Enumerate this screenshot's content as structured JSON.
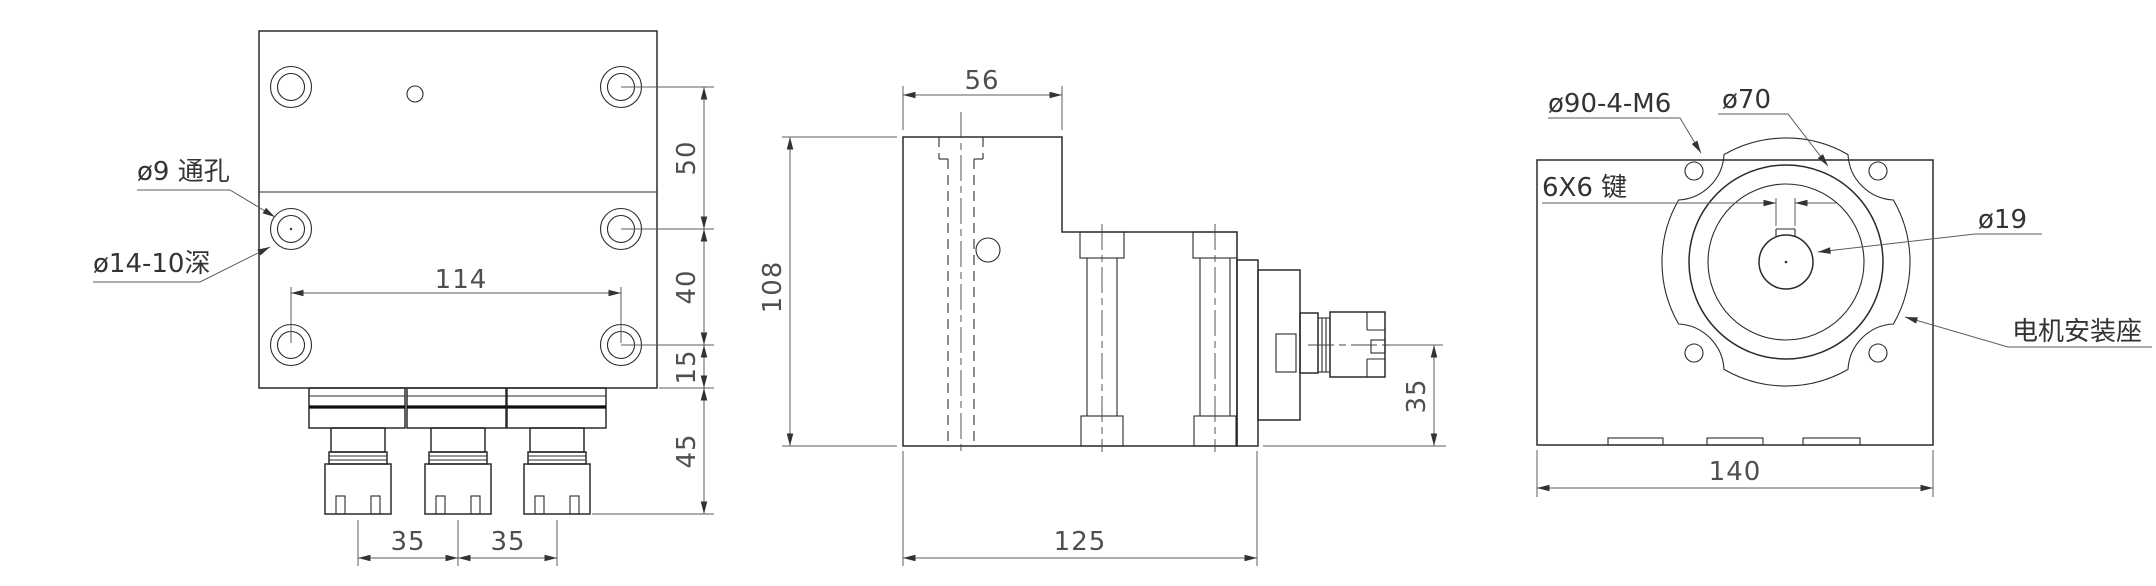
{
  "front_view": {
    "label_through_hole": "ø9 通孔",
    "label_counterbore": "ø14-10深",
    "dim_hole_spacing_h": "114",
    "dim_row_spacing_top": "50",
    "dim_row_spacing_mid": "40",
    "dim_row_to_base": "15",
    "dim_head_height": "45",
    "dim_spindle_pitch_1": "35",
    "dim_spindle_pitch_2": "35"
  },
  "side_view": {
    "dim_top_width": "56",
    "dim_body_height": "108",
    "dim_base_length": "125",
    "dim_spindle_center_height": "35"
  },
  "motor_view": {
    "label_bolt_circle": "ø90-4-M6",
    "label_register_diameter": "ø70",
    "label_key": "6X6 键",
    "label_shaft_diameter": "ø19",
    "label_motor_mount": "电机安装座",
    "dim_base_width": "140"
  }
}
